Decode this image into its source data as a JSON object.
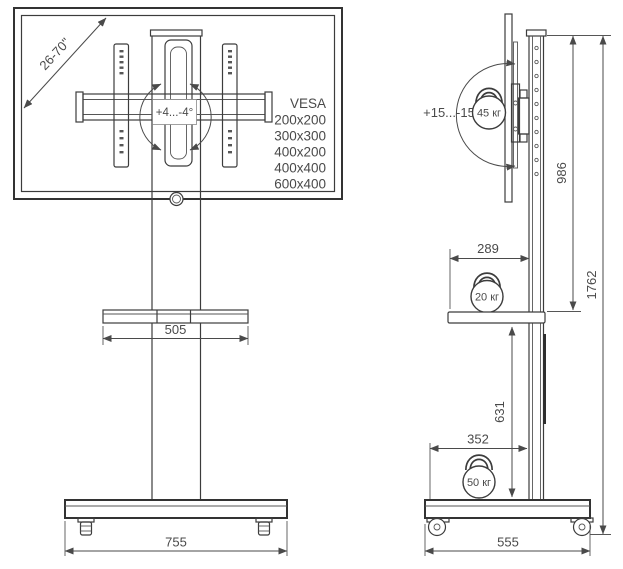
{
  "title": "Mobile TV floor stand — dimensional drawing (front and side views)",
  "colors": {
    "line": "#3c3c3c",
    "dimension": "#4a4a4a",
    "text": "#4a4a4a",
    "background": "#ffffff"
  },
  "front_view": {
    "screen_size_range": "26-70\"",
    "swivel_range": "+4...-4°",
    "vesa": {
      "title": "VESA",
      "sizes": [
        "200x200",
        "300x300",
        "400x200",
        "400x400",
        "600x400"
      ]
    },
    "shelf_width_mm": "505",
    "base_width_mm": "755"
  },
  "side_view": {
    "tilt_range": "+15...-15°",
    "max_tv_weight": "45 кг",
    "max_shelf_weight": "20 кг",
    "max_base_weight": "50 кг",
    "screen_center_height_mm": "986",
    "total_height_mm": "1762",
    "shelf_depth_mm": "289",
    "shelf_height_mm": "631",
    "base_front_offset_mm": "352",
    "base_depth_mm": "555"
  }
}
